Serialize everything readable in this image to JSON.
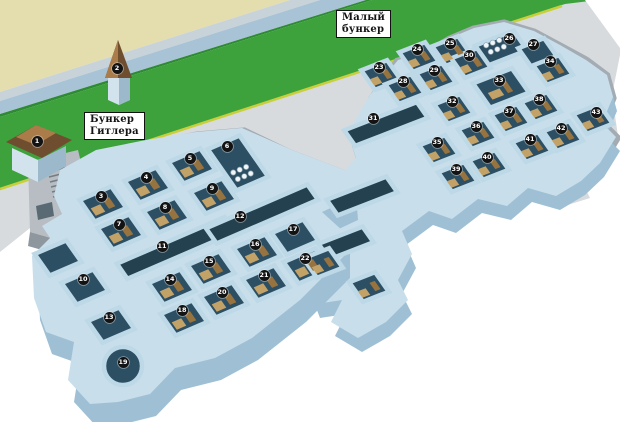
{
  "labels": {
    "hitler": [
      "Бункер",
      "Гитлера"
    ],
    "small": [
      "Малый",
      "бункер"
    ]
  },
  "colors": {
    "beige": "#e4ddae",
    "blue1": "#c7d2d9",
    "blue2": "#a8c3d6",
    "green": "#3da23c",
    "greenEdge": "#2e8a33",
    "yline": "#c9cf3a",
    "concrete": "#d7dbde",
    "cliff": "#a3acb3",
    "slab": "#c8deeb",
    "slabDark": "#9fc0d4",
    "floor": "#2d4f63",
    "floorDark": "#24414f",
    "wall": "#bdd8e6",
    "furn1": "#c3a268",
    "furn2": "#97733f",
    "marker": "#131313",
    "markerText": "#ffffff",
    "labelBg": "#ffffff",
    "labelBorder": "#111111",
    "roofDark": "#6f4e30",
    "roofLight": "#aa7c4a",
    "houseWall": "#d3e3ed",
    "houseShade": "#9cb9cb",
    "struct": "#b7bdc2",
    "structDark": "#8e979e"
  },
  "markers": [
    {
      "n": 1,
      "x": 37,
      "y": 141,
      "type": "poi"
    },
    {
      "n": 2,
      "x": 117,
      "y": 68,
      "type": "poi"
    },
    {
      "n": 3,
      "x": 101,
      "y": 196,
      "c": "L",
      "f": 1
    },
    {
      "n": 4,
      "x": 146,
      "y": 177,
      "c": "L",
      "f": 1
    },
    {
      "n": 5,
      "x": 190,
      "y": 158,
      "c": "L",
      "f": 1
    },
    {
      "n": 6,
      "x": 227,
      "y": 146,
      "c": "L",
      "ox": 11,
      "oy": 17,
      "wb": 1.9
    },
    {
      "n": 7,
      "x": 119,
      "y": 224,
      "c": "L",
      "f": 1
    },
    {
      "n": 8,
      "x": 165,
      "y": 207,
      "c": "L",
      "f": 1
    },
    {
      "n": 9,
      "x": 212,
      "y": 188,
      "c": "L",
      "f": 1
    },
    {
      "n": 10,
      "x": 83,
      "y": 279,
      "c": "L"
    },
    {
      "n": 11,
      "x": 162,
      "y": 246,
      "c": "L",
      "k": "corr",
      "ox": 14,
      "oy": 2,
      "wa": 3.4,
      "wb": 0.7
    },
    {
      "n": 12,
      "x": 240,
      "y": 216,
      "c": "L",
      "k": "corr",
      "ox": 22,
      "oy": -2,
      "wa": 3.2,
      "wb": 0.7
    },
    {
      "n": 13,
      "x": 109,
      "y": 317,
      "c": "L"
    },
    {
      "n": 14,
      "x": 170,
      "y": 279,
      "c": "L",
      "f": 1
    },
    {
      "n": 15,
      "x": 209,
      "y": 261,
      "c": "L",
      "f": 1
    },
    {
      "n": 16,
      "x": 255,
      "y": 244,
      "c": "L",
      "f": 1
    },
    {
      "n": 17,
      "x": 293,
      "y": 229,
      "c": "L"
    },
    {
      "n": 18,
      "x": 182,
      "y": 310,
      "c": "L",
      "f": 1
    },
    {
      "n": 19,
      "x": 123,
      "y": 362,
      "type": "round"
    },
    {
      "n": 20,
      "x": 222,
      "y": 292,
      "c": "L",
      "f": 1
    },
    {
      "n": 21,
      "x": 264,
      "y": 275,
      "c": "L",
      "f": 1
    },
    {
      "n": 22,
      "x": 305,
      "y": 258,
      "c": "L",
      "f": 1
    },
    {
      "n": 23,
      "x": 379,
      "y": 67,
      "c": "R",
      "f": 1
    },
    {
      "n": 24,
      "x": 417,
      "y": 49,
      "c": "R",
      "f": 1
    },
    {
      "n": 25,
      "x": 450,
      "y": 43,
      "c": "R",
      "f": 1
    },
    {
      "n": 26,
      "x": 509,
      "y": 38,
      "c": "R",
      "ox": -8,
      "oy": 10,
      "wa": 1.5
    },
    {
      "n": 27,
      "x": 533,
      "y": 44,
      "c": "R",
      "ox": 5,
      "oy": 9
    },
    {
      "n": 28,
      "x": 403,
      "y": 81,
      "c": "R",
      "f": 1
    },
    {
      "n": 29,
      "x": 434,
      "y": 70,
      "c": "R",
      "f": 1
    },
    {
      "n": 30,
      "x": 469,
      "y": 55,
      "c": "R",
      "f": 1
    },
    {
      "n": 31,
      "x": 373,
      "y": 118,
      "c": "R",
      "k": "corr",
      "ox": 13,
      "oy": 6,
      "wa": 2.8,
      "wb": 0.8
    },
    {
      "n": 32,
      "x": 452,
      "y": 101,
      "c": "R",
      "f": 1
    },
    {
      "n": 33,
      "x": 499,
      "y": 80,
      "c": "R",
      "wa": 1.5,
      "wb": 1.25,
      "f": 1
    },
    {
      "n": 34,
      "x": 550,
      "y": 61,
      "c": "R",
      "ox": 3,
      "oy": 9,
      "f": 1
    },
    {
      "n": 35,
      "x": 437,
      "y": 142,
      "c": "R",
      "f": 1
    },
    {
      "n": 36,
      "x": 476,
      "y": 126,
      "c": "R",
      "f": 1
    },
    {
      "n": 37,
      "x": 509,
      "y": 111,
      "c": "R",
      "f": 1
    },
    {
      "n": 38,
      "x": 539,
      "y": 99,
      "c": "R",
      "f": 1
    },
    {
      "n": 39,
      "x": 456,
      "y": 169,
      "c": "R",
      "f": 1
    },
    {
      "n": 40,
      "x": 487,
      "y": 157,
      "c": "R",
      "f": 1
    },
    {
      "n": 41,
      "x": 530,
      "y": 139,
      "c": "R",
      "f": 1
    },
    {
      "n": 42,
      "x": 561,
      "y": 128,
      "c": "R",
      "f": 1
    },
    {
      "n": 43,
      "x": 596,
      "y": 112,
      "c": "R",
      "ox": -3,
      "oy": 7,
      "f": 1
    }
  ],
  "extra_rooms": [
    {
      "x": 58,
      "y": 258,
      "c": "L"
    },
    {
      "x": 362,
      "y": 196,
      "c": "R",
      "k": "corr",
      "wa": 2.3,
      "wb": 0.8
    },
    {
      "x": 346,
      "y": 243,
      "c": "R",
      "k": "corr",
      "wa": 1.7,
      "wb": 0.8
    },
    {
      "x": 323,
      "y": 263,
      "c": "R",
      "f": 1
    },
    {
      "x": 369,
      "y": 287,
      "c": "R",
      "f": 1
    }
  ],
  "dots_rooms": [
    {
      "x": 242,
      "y": 173,
      "c": "L"
    },
    {
      "x": 495,
      "y": 46,
      "c": "R"
    }
  ]
}
